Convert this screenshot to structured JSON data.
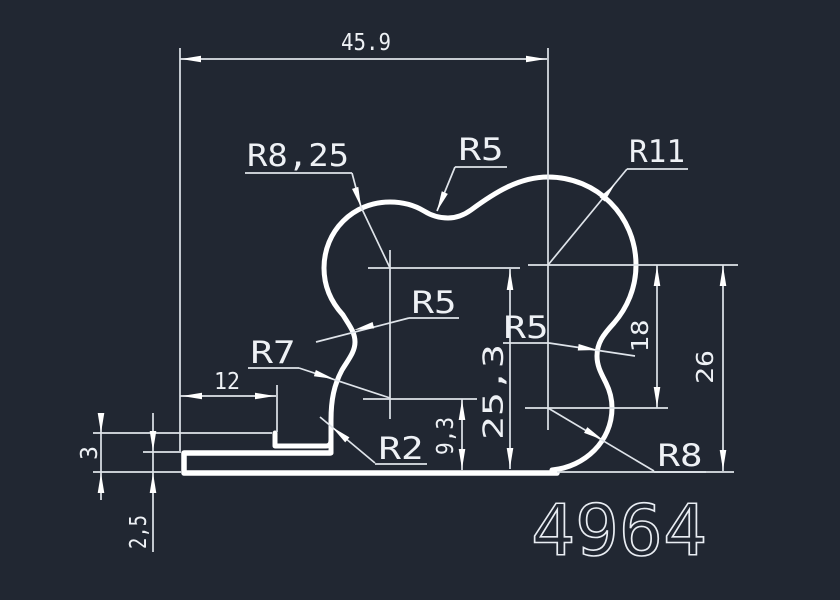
{
  "drawing": {
    "part_number": "4964",
    "colors": {
      "background": "#212732",
      "line": "#ffffff"
    },
    "dimensions": {
      "overall_width": "45.9",
      "flange_length": "12",
      "step_height": "3",
      "flange_thickness": "2,5",
      "height_small": "9,3",
      "height_main": "25,3",
      "height_right_inner": "18",
      "height_right_outer": "26"
    },
    "radii": {
      "top_left_lobe": "R8,25",
      "top_valley": "R5",
      "top_right_lobe": "R11",
      "left_waist": "R5",
      "right_waist": "R5",
      "left_lower_lobe": "R7",
      "bottom_corner": "R2",
      "bottom_right_lobe": "R8"
    }
  }
}
